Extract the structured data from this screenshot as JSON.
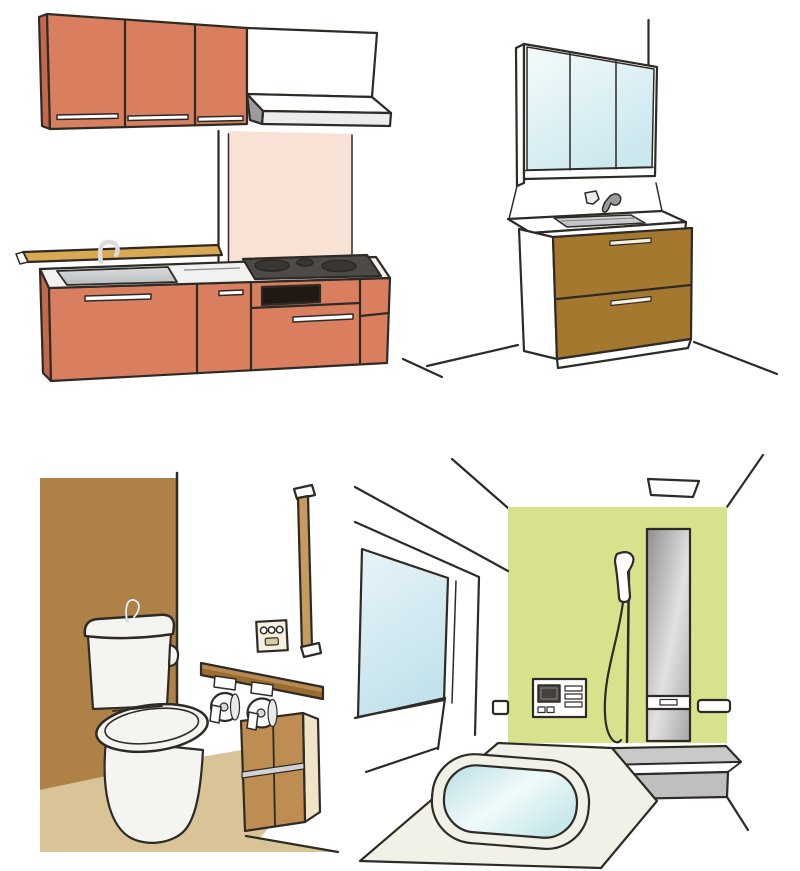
{
  "illustrations": {
    "kitchen": {
      "label": "system-kitchen-illustration"
    },
    "vanity": {
      "label": "washbasin-vanity-illustration"
    },
    "toilet": {
      "label": "toilet-room-illustration"
    },
    "bathroom": {
      "label": "unit-bath-illustration"
    }
  },
  "colors": {
    "white": "#FFFFFF",
    "outline": "#2E2A26",
    "salmon": "#D97F60",
    "salmon_dark": "#C3674D",
    "backsplash_pink": "#F8E1D5",
    "ledge_tan": "#D8A853",
    "counter_light": "#F1F1EF",
    "sink_gray_1": "#DCDCDC",
    "sink_gray_2": "#B7BBBD",
    "stove_gray": "#4E4A47",
    "burner_dark": "#3A3633",
    "hood_shadow": "#9C9C9C",
    "hood_band": "#ECECEC",
    "mirror_1": "#F4FBFC",
    "mirror_2": "#CBE8EE",
    "vanity_brown": "#A5782F",
    "handle_cream": "#F4EFE0",
    "faucet_gray": "#9A9A9A",
    "faucet_light": "#EDEDED",
    "wall_brown": "#AE8146",
    "floor_tan": "#D9C498",
    "porcelain": "#F4F4F0",
    "rail_tan": "#C59B5F",
    "panel_cream": "#F6F0E1",
    "panel_button": "#D8CDA8",
    "shelf_top": "#B78A52",
    "shelf_front": "#9A6C2D",
    "cabinet_wood": "#BE8D51",
    "cabinet_side": "#EFE3C8",
    "cabinet_band": "#D2D2D2",
    "bath_green": "#D8E28C",
    "glass_1": "#E8F4F8",
    "glass_2": "#C3E2EC",
    "column_1": "#8F8F8F",
    "column_2": "#E2E2E2",
    "column_3": "#A6A6A6",
    "ledge_gray": "#C9C9C9",
    "ledge_base": "#BFBFBF",
    "tub_cream": "#F2F1E7",
    "water_1": "#B9DFE4",
    "water_2": "#F0FAFA",
    "water_3": "#C7E8EA",
    "screen_dark": "#44403C",
    "roll_core": "#D9D9D9",
    "paper_shadow": "#E9E9E9"
  }
}
